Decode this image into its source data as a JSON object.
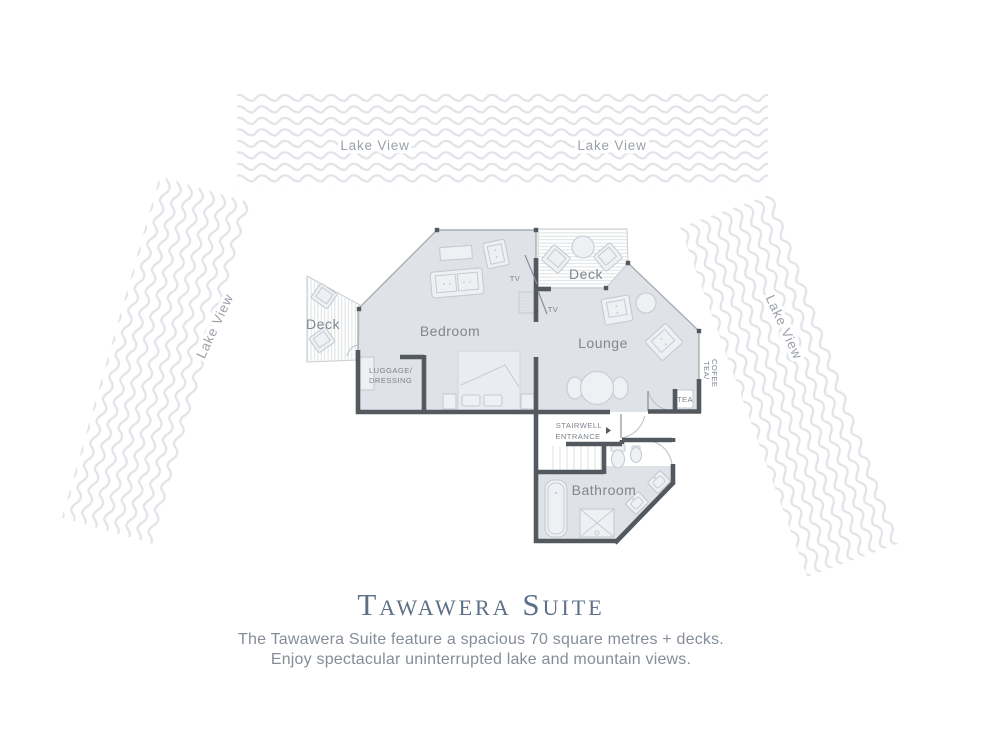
{
  "lake": {
    "top_left": "Lake View",
    "top_right": "Lake View",
    "left": "Lake View",
    "right": "Lake View"
  },
  "rooms": {
    "bedroom": "Bedroom",
    "lounge": "Lounge",
    "bathroom": "Bathroom",
    "deck_left": "Deck",
    "deck_top": "Deck"
  },
  "small_labels": {
    "luggage1": "LUGGAGE/",
    "luggage2": "DRESSING",
    "stair1": "STAIRWELL",
    "stair2": "ENTRANCE",
    "tea": "TEA",
    "teacoffee1": "TEA/",
    "teacoffee2": "COFEE",
    "tv1": "TV",
    "tv2": "TV"
  },
  "footer": {
    "title": "Tawawera Suite",
    "line1": "The Tawawera Suite feature a spacious 70 square metres + decks.",
    "line2": "Enjoy spectacular uninterrupted lake and mountain views."
  },
  "colors": {
    "wave": "#e1e4e8",
    "lake-text": "#9aa1a9",
    "room-fill": "#dfe2e7",
    "wall": "#54595f",
    "thin": "#a7adb4",
    "furn-stroke": "#c5cbd2",
    "furn-fill": "#eef1f4",
    "stripe": "#d9dde1",
    "label": "#81878e",
    "small-label": "#7e848b",
    "title-color": "#5d7086",
    "desc-color": "#858d98"
  }
}
